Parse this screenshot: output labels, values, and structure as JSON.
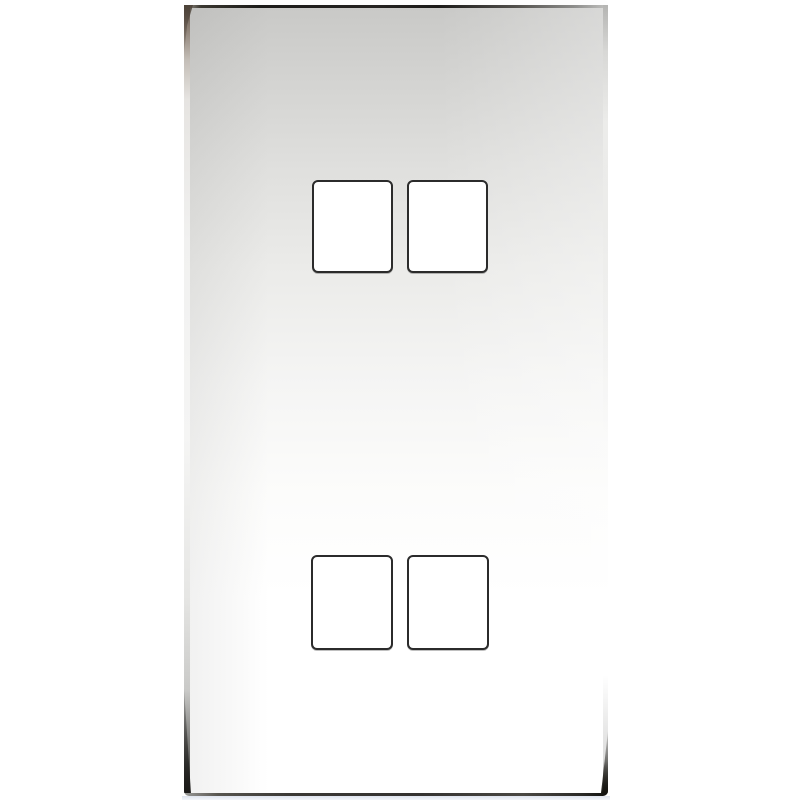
{
  "scene": {
    "description": "Product photograph of a polished chrome 4-gang grid switch faceplate with four square module cutouts, shown front-on against a plain white background. No text or labels are visible.",
    "subject": "grid-switch-faceplate",
    "finish": "polished-chrome",
    "background": "plain-white",
    "cutouts": {
      "count": 4,
      "rows": 2,
      "columns": 2,
      "items": [
        {
          "id": "top-left"
        },
        {
          "id": "top-right"
        },
        {
          "id": "bottom-left"
        },
        {
          "id": "bottom-right"
        }
      ]
    },
    "colors": {
      "background": "#ffffff",
      "face_top": "#c9c9c7",
      "face_mid": "#ebebe9",
      "face_bottom": "#ffffff",
      "edge_line_dark": "#1b1a18",
      "edge_line_soft": "#8d8d8b",
      "left_edge_top_tint": "#5f5349",
      "corner_reflection": "#14130f",
      "cutout_fill": "#ffffff",
      "cutout_border": "#2b2b2b",
      "under_shadow": "#dde2ee"
    }
  }
}
